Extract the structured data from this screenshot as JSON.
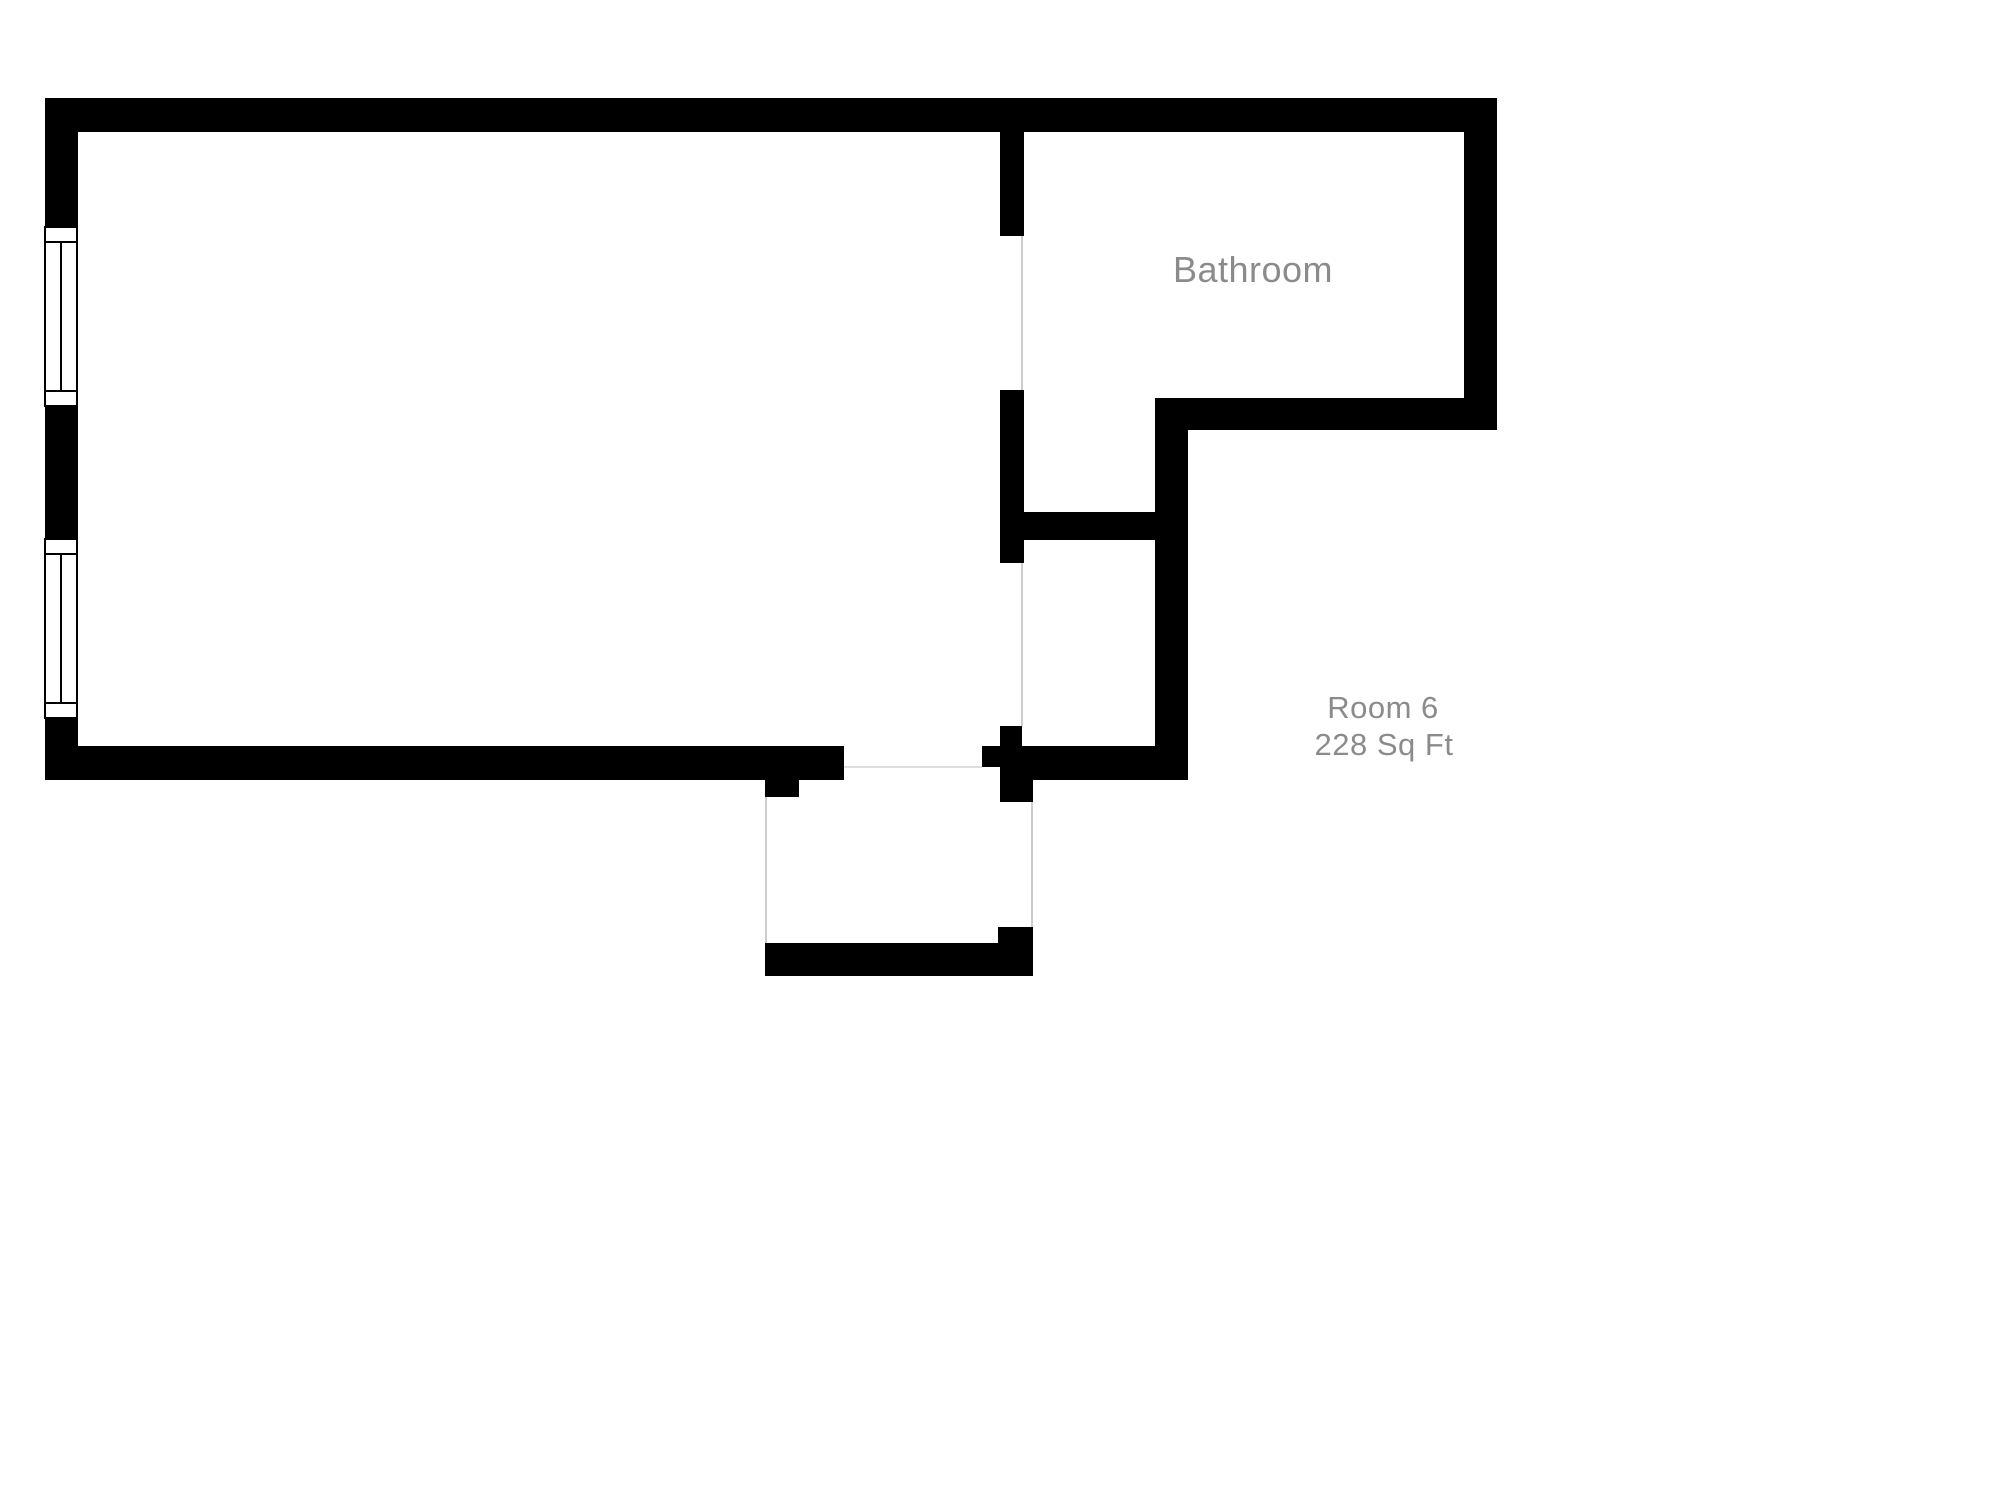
{
  "page": {
    "background": "#ffffff"
  },
  "colors": {
    "wall": "#000000",
    "label_text": "#8b8b8b",
    "opening_line": "#cccccc",
    "threshold_line": "#dddddd",
    "window_fill": "#ffffff",
    "window_border": "#000000"
  },
  "labels": {
    "bathroom": {
      "text": "Bathroom",
      "x": 1253,
      "y": 270,
      "font_size": 36
    },
    "room_name": {
      "text": "Room 6",
      "x": 1383,
      "y": 708,
      "font_size": 31
    },
    "room_area": {
      "text": "228 Sq Ft",
      "x": 1384,
      "y": 745,
      "font_size": 31
    }
  },
  "floorplan": {
    "walls": [
      {
        "name": "wall-top",
        "x": 45,
        "y": 98,
        "w": 1452,
        "h": 34
      },
      {
        "name": "wall-left",
        "x": 45,
        "y": 98,
        "w": 33,
        "h": 682
      },
      {
        "name": "wall-right",
        "x": 1464,
        "y": 98,
        "w": 33,
        "h": 332
      },
      {
        "name": "wall-bottom-main",
        "x": 45,
        "y": 746,
        "w": 799,
        "h": 34
      },
      {
        "name": "wall-bathroom-partition-upper",
        "x": 1000,
        "y": 132,
        "w": 24,
        "h": 104
      },
      {
        "name": "wall-bathroom-partition-lower",
        "x": 1000,
        "y": 390,
        "w": 24,
        "h": 173
      },
      {
        "name": "wall-closet-top",
        "x": 1024,
        "y": 512,
        "w": 131,
        "h": 28
      },
      {
        "name": "wall-closet-right",
        "x": 1155,
        "y": 398,
        "w": 33,
        "h": 382
      },
      {
        "name": "wall-bathroom-bottom",
        "x": 1155,
        "y": 398,
        "w": 309,
        "h": 32
      },
      {
        "name": "wall-hall-bottom",
        "x": 1000,
        "y": 746,
        "w": 188,
        "h": 34
      },
      {
        "name": "wall-entry-nub",
        "x": 982,
        "y": 746,
        "w": 18,
        "h": 21
      },
      {
        "name": "wall-entry-jamb-upper",
        "x": 1000,
        "y": 726,
        "w": 22,
        "h": 20
      },
      {
        "name": "wall-entry-jamb-lower",
        "x": 1000,
        "y": 780,
        "w": 33,
        "h": 22
      },
      {
        "name": "wall-vestibule-left-jamb",
        "x": 765,
        "y": 780,
        "w": 34,
        "h": 17
      },
      {
        "name": "wall-vestibule-bottom",
        "x": 765,
        "y": 943,
        "w": 268,
        "h": 33
      },
      {
        "name": "wall-vestibule-right-corner",
        "x": 998,
        "y": 927,
        "w": 35,
        "h": 16
      }
    ],
    "opening_lines": [
      {
        "name": "line-bathroom-door-opening",
        "x": 1021,
        "y": 236,
        "w": 2,
        "h": 154
      },
      {
        "name": "line-closet-opening",
        "x": 1021,
        "y": 563,
        "w": 2,
        "h": 163
      },
      {
        "name": "line-vestibule-left",
        "x": 765,
        "y": 797,
        "w": 2,
        "h": 146
      },
      {
        "name": "line-vestibule-right",
        "x": 1031,
        "y": 802,
        "w": 2,
        "h": 125
      },
      {
        "name": "line-entry-threshold",
        "x": 844,
        "y": 766,
        "w": 138,
        "h": 2
      }
    ],
    "windows": [
      {
        "name": "window-upper",
        "x": 44,
        "y": 226,
        "w": 34,
        "h": 181,
        "end_box": 15
      },
      {
        "name": "window-lower",
        "x": 44,
        "y": 538,
        "w": 34,
        "h": 181,
        "end_box": 15
      }
    ]
  }
}
